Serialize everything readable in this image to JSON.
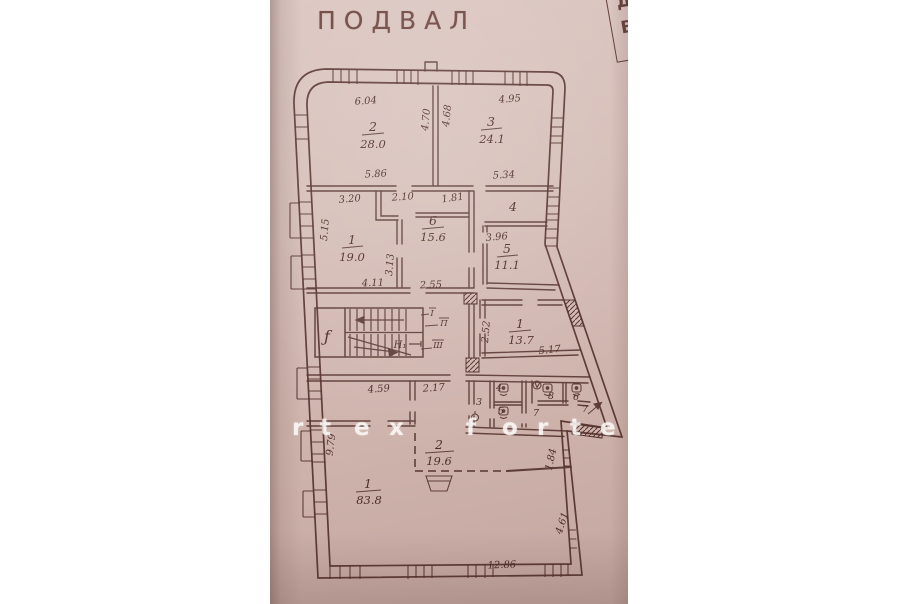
{
  "title": "ПОДВАЛ",
  "stamp": {
    "letter_top": "Д",
    "letter_bottom": "В"
  },
  "watermark": {
    "letters": [
      "r",
      "t",
      "e",
      "x",
      "f",
      "o",
      "r",
      "t",
      "e"
    ]
  },
  "plan": {
    "rooms": {
      "r2": {
        "number": "2",
        "area": "28.0"
      },
      "r3": {
        "number": "3",
        "area": "24.1"
      },
      "r1_mid": {
        "number": "1",
        "area": "19.0"
      },
      "r6": {
        "number": "6",
        "area": "15.6"
      },
      "r4": {
        "number": "4"
      },
      "r5": {
        "number": "5",
        "area": "11.1"
      },
      "r1_stair": {
        "number": "1",
        "area": "13.7"
      },
      "r2_low": {
        "number": "2",
        "area": "19.6"
      },
      "r1_big": {
        "number": "1",
        "area": "83.8"
      },
      "wc3": {
        "number": "3"
      },
      "wc4": {
        "number": "4"
      },
      "wc5": {
        "number": "5"
      },
      "wc7": {
        "number": "7"
      },
      "wc8": {
        "number": "8"
      },
      "wc6": {
        "number": "6"
      },
      "wc7b": {
        "number": "7"
      }
    },
    "dims": {
      "room2_top": "6.04",
      "room2_wall": "4.70",
      "room3_wall": "4.68",
      "room3_top": "4.95",
      "room2_bottom": "5.86",
      "room3_bottom": "5.34",
      "room1_top": "3.20",
      "corridor_mid": "2.10",
      "corridor_right": "1.81",
      "room1_left": "5.15",
      "room6_left": "3.13",
      "room5_top": "3.96",
      "room1_bottom": "4.11",
      "room6_bottom": "2.55",
      "room13_left": "2.52",
      "room13_bottom": "5.17",
      "hall_top": "4.59",
      "hall_corridor": "2.17",
      "hall_left": "9.79",
      "right_upper": "1.84",
      "right_lower": "4.61",
      "bottom": "12.86"
    },
    "marks": {
      "stair": "Н₁",
      "script": "ƒ",
      "tag1": "I",
      "tag2": "П",
      "tag3": "Ш"
    }
  },
  "colors": {
    "paper": "#d6beb8",
    "ink": "#5a3531",
    "margin": "#ffffff"
  }
}
